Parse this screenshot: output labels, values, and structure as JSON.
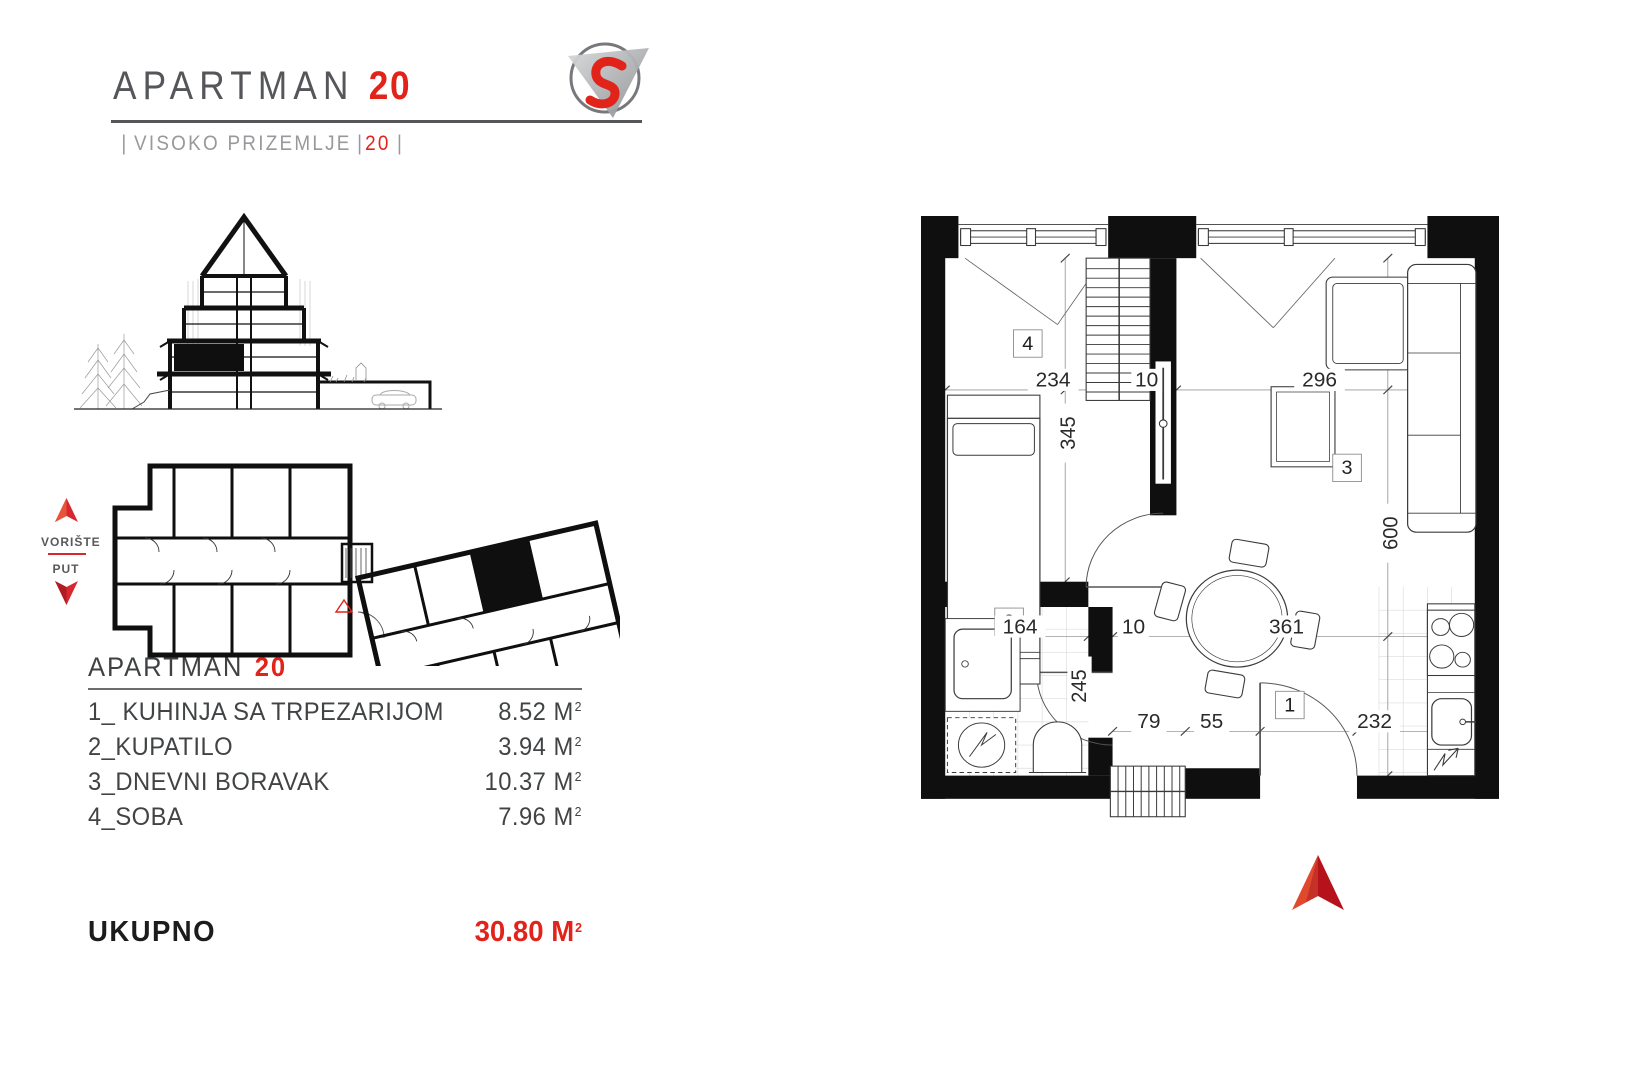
{
  "header": {
    "title": "APARTMAN",
    "number": "20",
    "subtitle": {
      "bar": "|",
      "label": "VISOKO PRIZEMLJE",
      "number": "20"
    }
  },
  "logo": {
    "icon": "s-swoosh-triangle-logo"
  },
  "site_plan": {
    "legend": {
      "top": "DVORIŠTE",
      "bottom": "PUT"
    },
    "marker_icons": [
      "red-up-arrow-icon",
      "red-down-arrow-icon",
      "red-triangle-outline-icon"
    ]
  },
  "room_list": {
    "title": "APARTMAN",
    "number": "20",
    "unit": "M",
    "unit_sup": "2",
    "rows": [
      {
        "label": "1_ KUHINJA SA TRPEZARIJOM",
        "area": "8.52"
      },
      {
        "label": "2_KUPATILO",
        "area": "3.94"
      },
      {
        "label": "3_DNEVNI BORAVAK",
        "area": "10.37"
      },
      {
        "label": "4_SOBA",
        "area": "7.96"
      }
    ],
    "total_label": "UKUPNO",
    "total_area": "30.80"
  },
  "floor_plan": {
    "rooms": [
      {
        "id": "1"
      },
      {
        "id": "2"
      },
      {
        "id": "3"
      },
      {
        "id": "4"
      }
    ],
    "dims": {
      "bedroom_w": "234",
      "wall_a": "10",
      "living_w": "296",
      "bedroom_h": "345",
      "living_h": "600",
      "bath_w": "164",
      "wall_b": "10",
      "dining_w": "361",
      "bath_h": "245",
      "entry_a": "79",
      "entry_b": "55",
      "kitchen_w": "232"
    },
    "north_icon": "north-arrow-icon"
  },
  "colors": {
    "accent_red": "#e2231a",
    "title_gray": "#54565a",
    "subtitle_gray": "#97999c",
    "wall_black": "#0f0f0f"
  }
}
